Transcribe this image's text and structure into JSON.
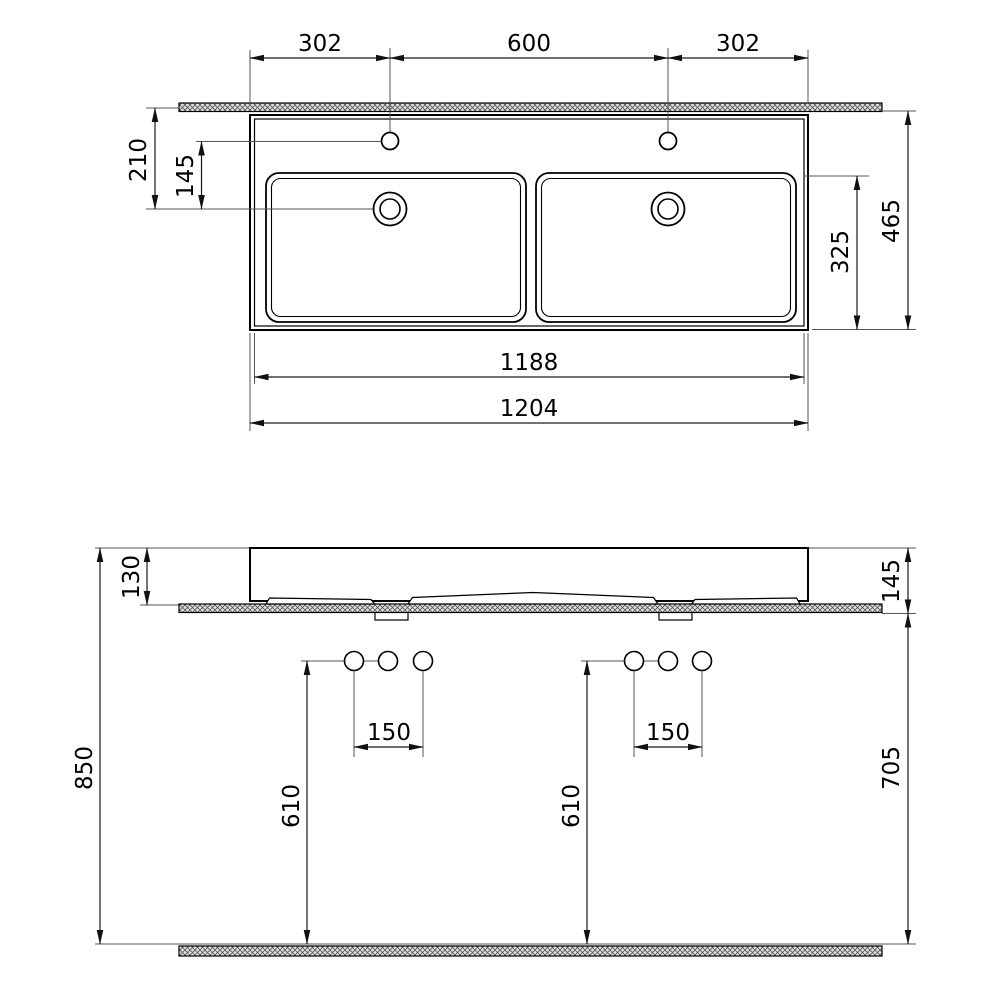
{
  "drawing_type": "sanitary ware technical dimension drawing, double washbasin, two views",
  "colors": {
    "background": "#ffffff",
    "object_line": "#000000",
    "dimension_line": "#1a1a1a",
    "extension_line": "#555555",
    "hatch_fill": "#e2e2e2",
    "hatch_line": "#555555"
  },
  "top_view": {
    "view_name": "plan view",
    "dims": {
      "faucet_offset_left": "302",
      "faucet_spacing": "600",
      "faucet_offset_right": "302",
      "edge_to_drain": "210",
      "holes_to_drain": "145",
      "bowl_depth": "325",
      "overall_depth": "465",
      "inner_width": "1188",
      "overall_width": "1204"
    }
  },
  "front_view": {
    "view_name": "front elevation",
    "dims": {
      "rim_above_counter": "130",
      "rim_to_counter_bottom": "145",
      "floor_to_rim": "850",
      "floor_to_counter_bottom": "705",
      "hole_spacing_left": "150",
      "hole_spacing_right": "150",
      "floor_to_holes_left": "610",
      "floor_to_holes_right": "610"
    }
  }
}
